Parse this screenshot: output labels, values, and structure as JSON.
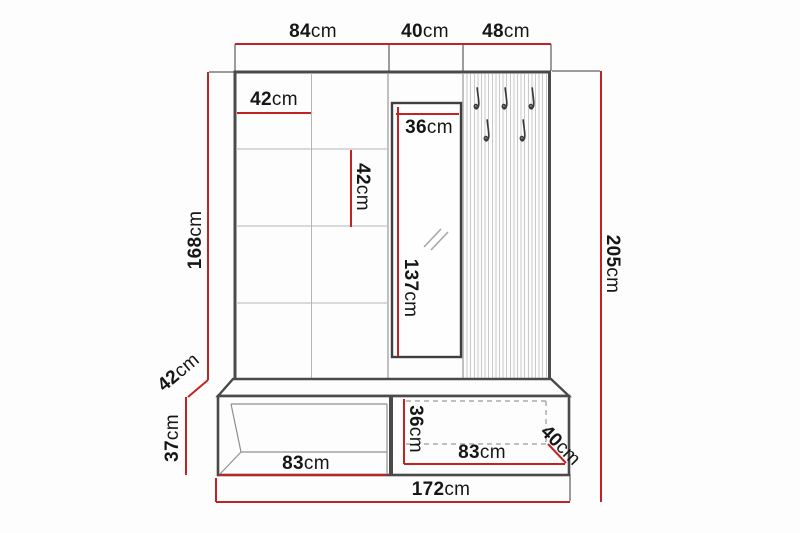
{
  "diagram": {
    "kind": "hallway-furniture-dimension-drawing",
    "colors": {
      "dimension_red": "#c32222",
      "outline_gray": "#4a4a4a",
      "grid_gray": "#b5b5b5",
      "text_black": "#161616"
    },
    "icons": {
      "coat_hook": "j-shaped-hook-glyph",
      "mirror_reflection": "double-slash-glyph"
    },
    "dimensions": {
      "top_left_width": {
        "value": "84",
        "unit": "cm"
      },
      "top_middle_width": {
        "value": "40",
        "unit": "cm"
      },
      "top_right_width": {
        "value": "48",
        "unit": "cm"
      },
      "square_width": {
        "value": "42",
        "unit": "cm"
      },
      "square_height": {
        "value": "42",
        "unit": "cm"
      },
      "mirror_width": {
        "value": "36",
        "unit": "cm"
      },
      "mirror_height": {
        "value": "137",
        "unit": "cm"
      },
      "panel_height": {
        "value": "168",
        "unit": "cm"
      },
      "total_height": {
        "value": "205",
        "unit": "cm"
      },
      "bench_top_depth": {
        "value": "42",
        "unit": "cm"
      },
      "bench_height": {
        "value": "37",
        "unit": "cm"
      },
      "open_shelf_width": {
        "value": "83",
        "unit": "cm"
      },
      "drawer_height": {
        "value": "36",
        "unit": "cm"
      },
      "drawer_width": {
        "value": "83",
        "unit": "cm"
      },
      "bench_bottom_depth": {
        "value": "40",
        "unit": "cm"
      },
      "total_width": {
        "value": "172",
        "unit": "cm"
      }
    }
  }
}
